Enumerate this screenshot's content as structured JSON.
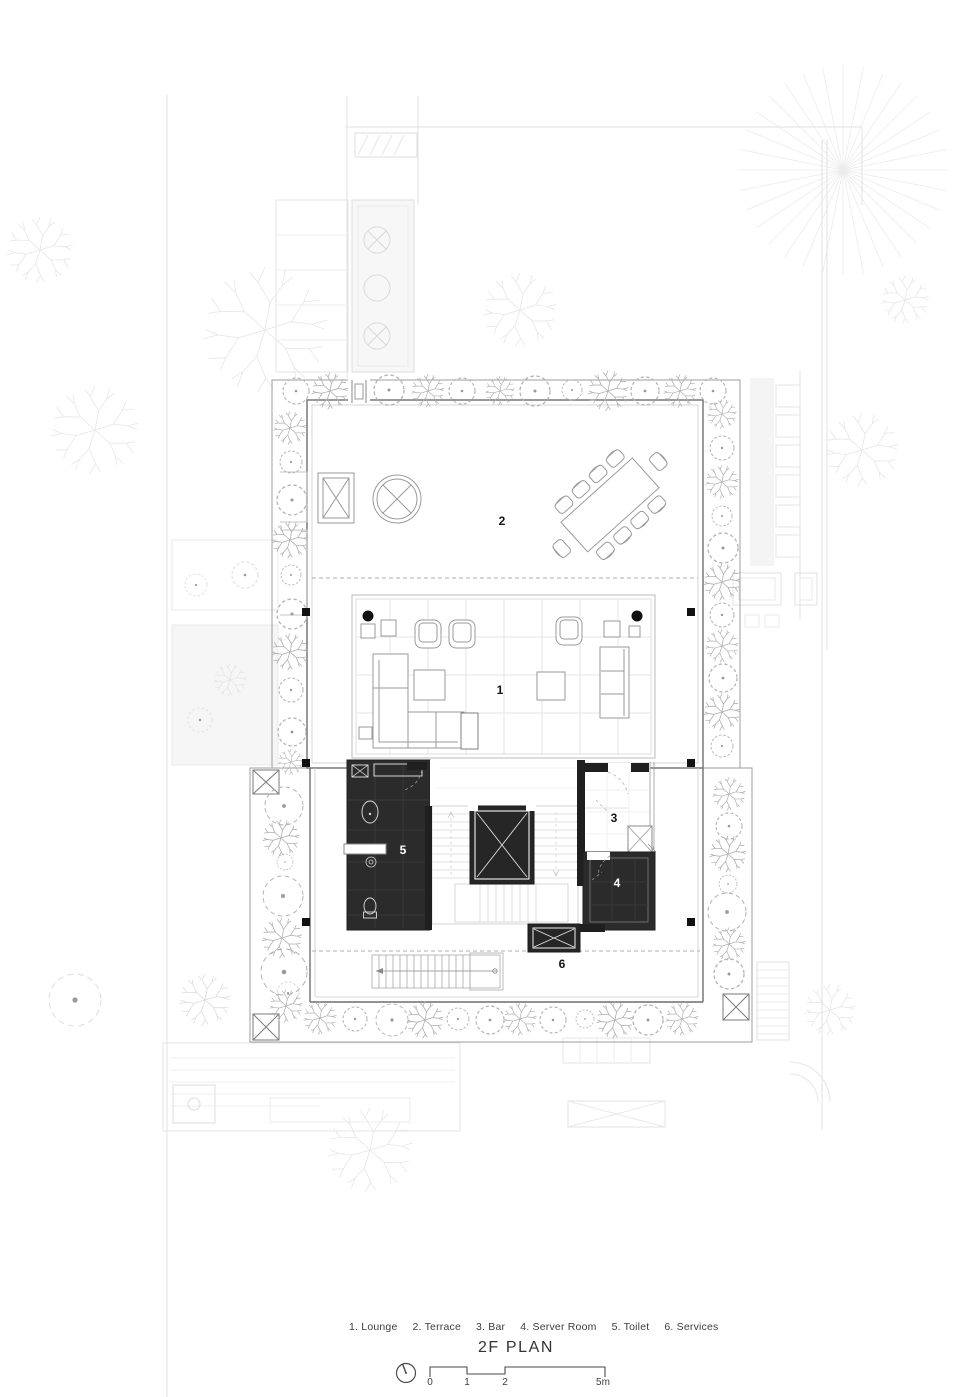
{
  "plan": {
    "title": "2F PLAN",
    "rooms": [
      {
        "num": "1",
        "name": "Lounge"
      },
      {
        "num": "2",
        "name": "Terrace"
      },
      {
        "num": "3",
        "name": "Bar"
      },
      {
        "num": "4",
        "name": "Server Room"
      },
      {
        "num": "5",
        "name": "Toilet"
      },
      {
        "num": "6",
        "name": "Services"
      }
    ],
    "legend_items": [
      "1. Lounge",
      "2. Terrace",
      "3. Bar",
      "4. Server Room",
      "5. Toilet",
      "6. Services"
    ],
    "scale_bar": {
      "tick_labels": [
        "0",
        "1",
        "2",
        "5m"
      ],
      "units": "m"
    },
    "icons": {
      "north": "north-clock-icon"
    },
    "colors": {
      "dark_room": "#2b2b2b",
      "wall": "#1f1f1f",
      "drawing_line": "#9a9a9a",
      "tree_line": "#b5b5b5",
      "context_line": "#e8e8e8",
      "label_dark": "#141414",
      "label_light": "#ffffff"
    }
  }
}
